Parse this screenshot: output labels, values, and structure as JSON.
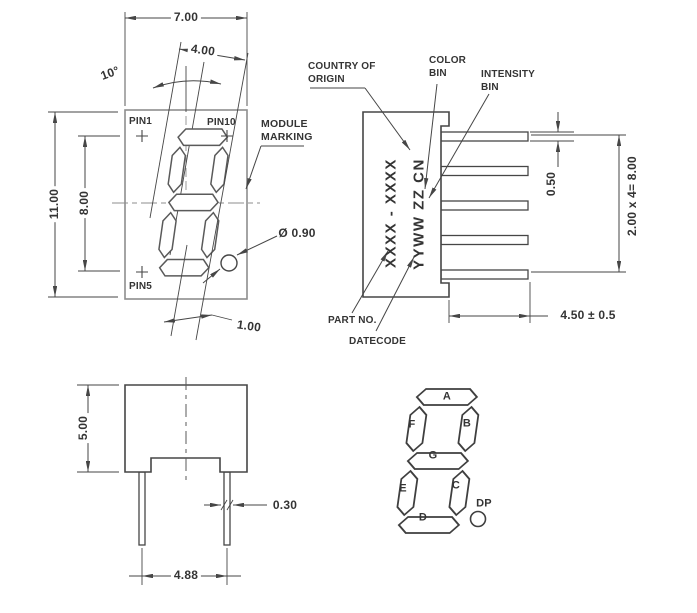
{
  "drawing": {
    "front_view": {
      "dim_body_width": "7.00",
      "dim_digit_width": "4.00",
      "dim_tilt_angle": "10°",
      "dim_body_height": "11.00",
      "dim_pin_row_span": "8.00",
      "dim_segment_width": "1.00",
      "dim_dp_diameter": "Ø 0.90",
      "pin1_label": "PIN1",
      "pin10_label": "PIN10",
      "pin5_label": "PIN5",
      "module_marking_line1": "MODULE",
      "module_marking_line2": "MARKING"
    },
    "side_view": {
      "country_of_origin_line1": "COUNTRY OF",
      "country_of_origin_line2": "ORIGIN",
      "color_bin_line1": "COLOR",
      "color_bin_line2": "BIN",
      "intensity_bin_line1": "INTENSITY",
      "intensity_bin_line2": "BIN",
      "part_no_label": "PART NO.",
      "datecode_label": "DATECODE",
      "marking_row1": "XXXX - XXXX",
      "marking_row2": "YYWW ZZ CN",
      "dim_pin_thickness": "0.50",
      "dim_pin_pitch": "2.00 x 4= 8.00",
      "dim_pin_length": "4.50 ± 0.5"
    },
    "bottom_view": {
      "dim_body_height": "5.00",
      "dim_pin_width": "0.30",
      "dim_pin_spacing": "4.88"
    },
    "segment_diagram": {
      "seg_a": "A",
      "seg_b": "B",
      "seg_c": "C",
      "seg_d": "D",
      "seg_e": "E",
      "seg_f": "F",
      "seg_g": "G",
      "dp_label": "DP"
    },
    "colors": {
      "line": "#464646",
      "light_line": "#8e8e8e",
      "text": "#343434",
      "background": "#ffffff"
    }
  }
}
